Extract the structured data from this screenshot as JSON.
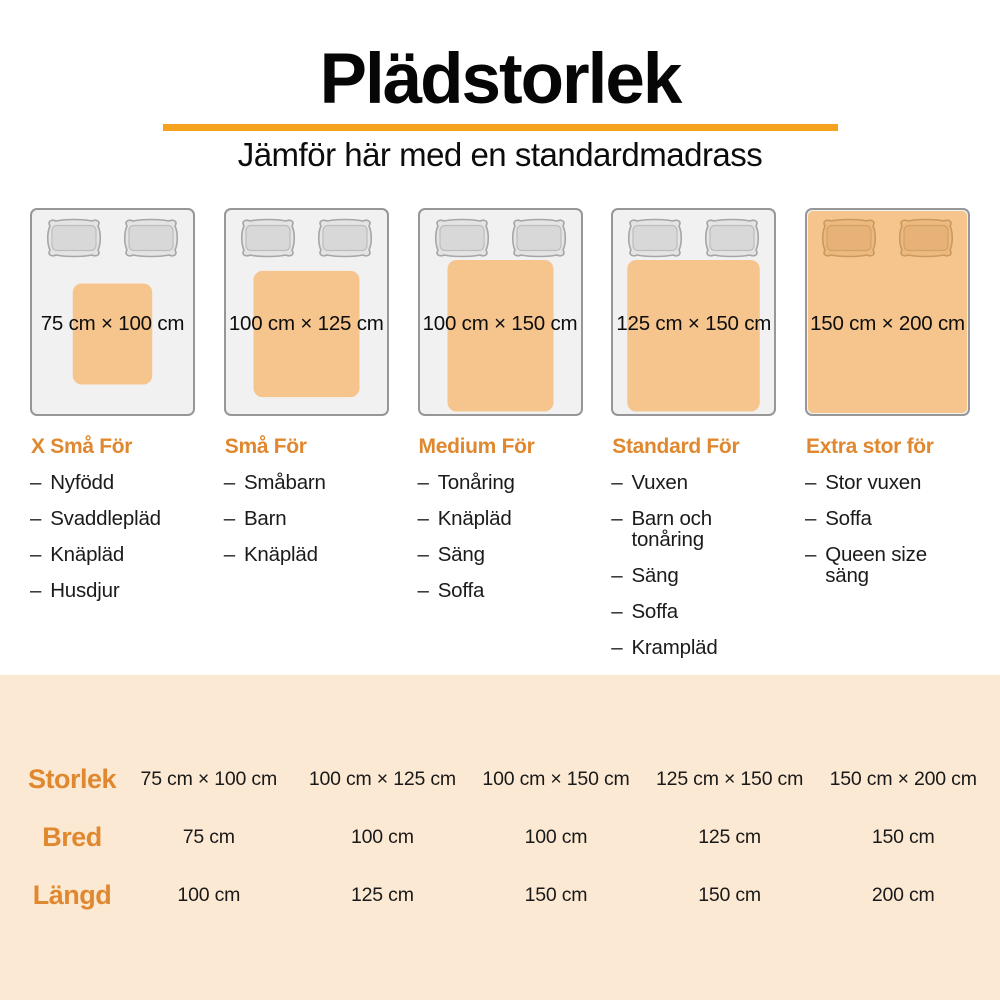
{
  "title": "Plädstorlek",
  "subtitle": "Jämför här med en standardmadrass",
  "list_bullet": "–",
  "colors": {
    "accent": "#F5A31E",
    "heading": "#E0882F",
    "blanket": "#F6C48D",
    "table_bg": "#FCE9D3",
    "mattress_fill": "#F1F1F1",
    "mattress_border": "#979797",
    "pillow_fill": "#E4E4E4",
    "pillow_border": "#A6A6A6"
  },
  "columns": [
    {
      "size_label": "75 cm × 100 cm",
      "width_cm": 75,
      "length_cm": 100,
      "heading": "X Små För",
      "items": [
        "Nyfödd",
        "Svaddlepläd",
        "Knäpläd",
        "Husdjur"
      ]
    },
    {
      "size_label": "100 cm × 125 cm",
      "width_cm": 100,
      "length_cm": 125,
      "heading": "Små För",
      "items": [
        "Småbarn",
        "Barn",
        "Knäpläd"
      ]
    },
    {
      "size_label": "100 cm × 150 cm",
      "width_cm": 100,
      "length_cm": 150,
      "heading": "Medium För",
      "items": [
        "Tonåring",
        "Knäpläd",
        "Säng",
        "Soffa"
      ]
    },
    {
      "size_label": "125 cm × 150 cm",
      "width_cm": 125,
      "length_cm": 150,
      "heading": "Standard För",
      "items": [
        "Vuxen",
        "Barn och tonåring",
        "Säng",
        "Soffa",
        "Krampläd"
      ]
    },
    {
      "size_label": "150 cm × 200 cm",
      "width_cm": 150,
      "length_cm": 200,
      "heading": "Extra stor för",
      "items": [
        "Stor vuxen",
        "Soffa",
        "Queen size säng"
      ]
    }
  ],
  "table": {
    "rows": [
      {
        "label": "Storlek",
        "values": [
          "75 cm × 100 cm",
          "100 cm × 125 cm",
          "100 cm × 150 cm",
          "125 cm × 150 cm",
          "150 cm × 200 cm"
        ]
      },
      {
        "label": "Bred",
        "values": [
          "75 cm",
          "100 cm",
          "100 cm",
          "125 cm",
          "150 cm"
        ]
      },
      {
        "label": "Längd",
        "values": [
          "100 cm",
          "125 cm",
          "150 cm",
          "150 cm",
          "200 cm"
        ]
      }
    ]
  }
}
